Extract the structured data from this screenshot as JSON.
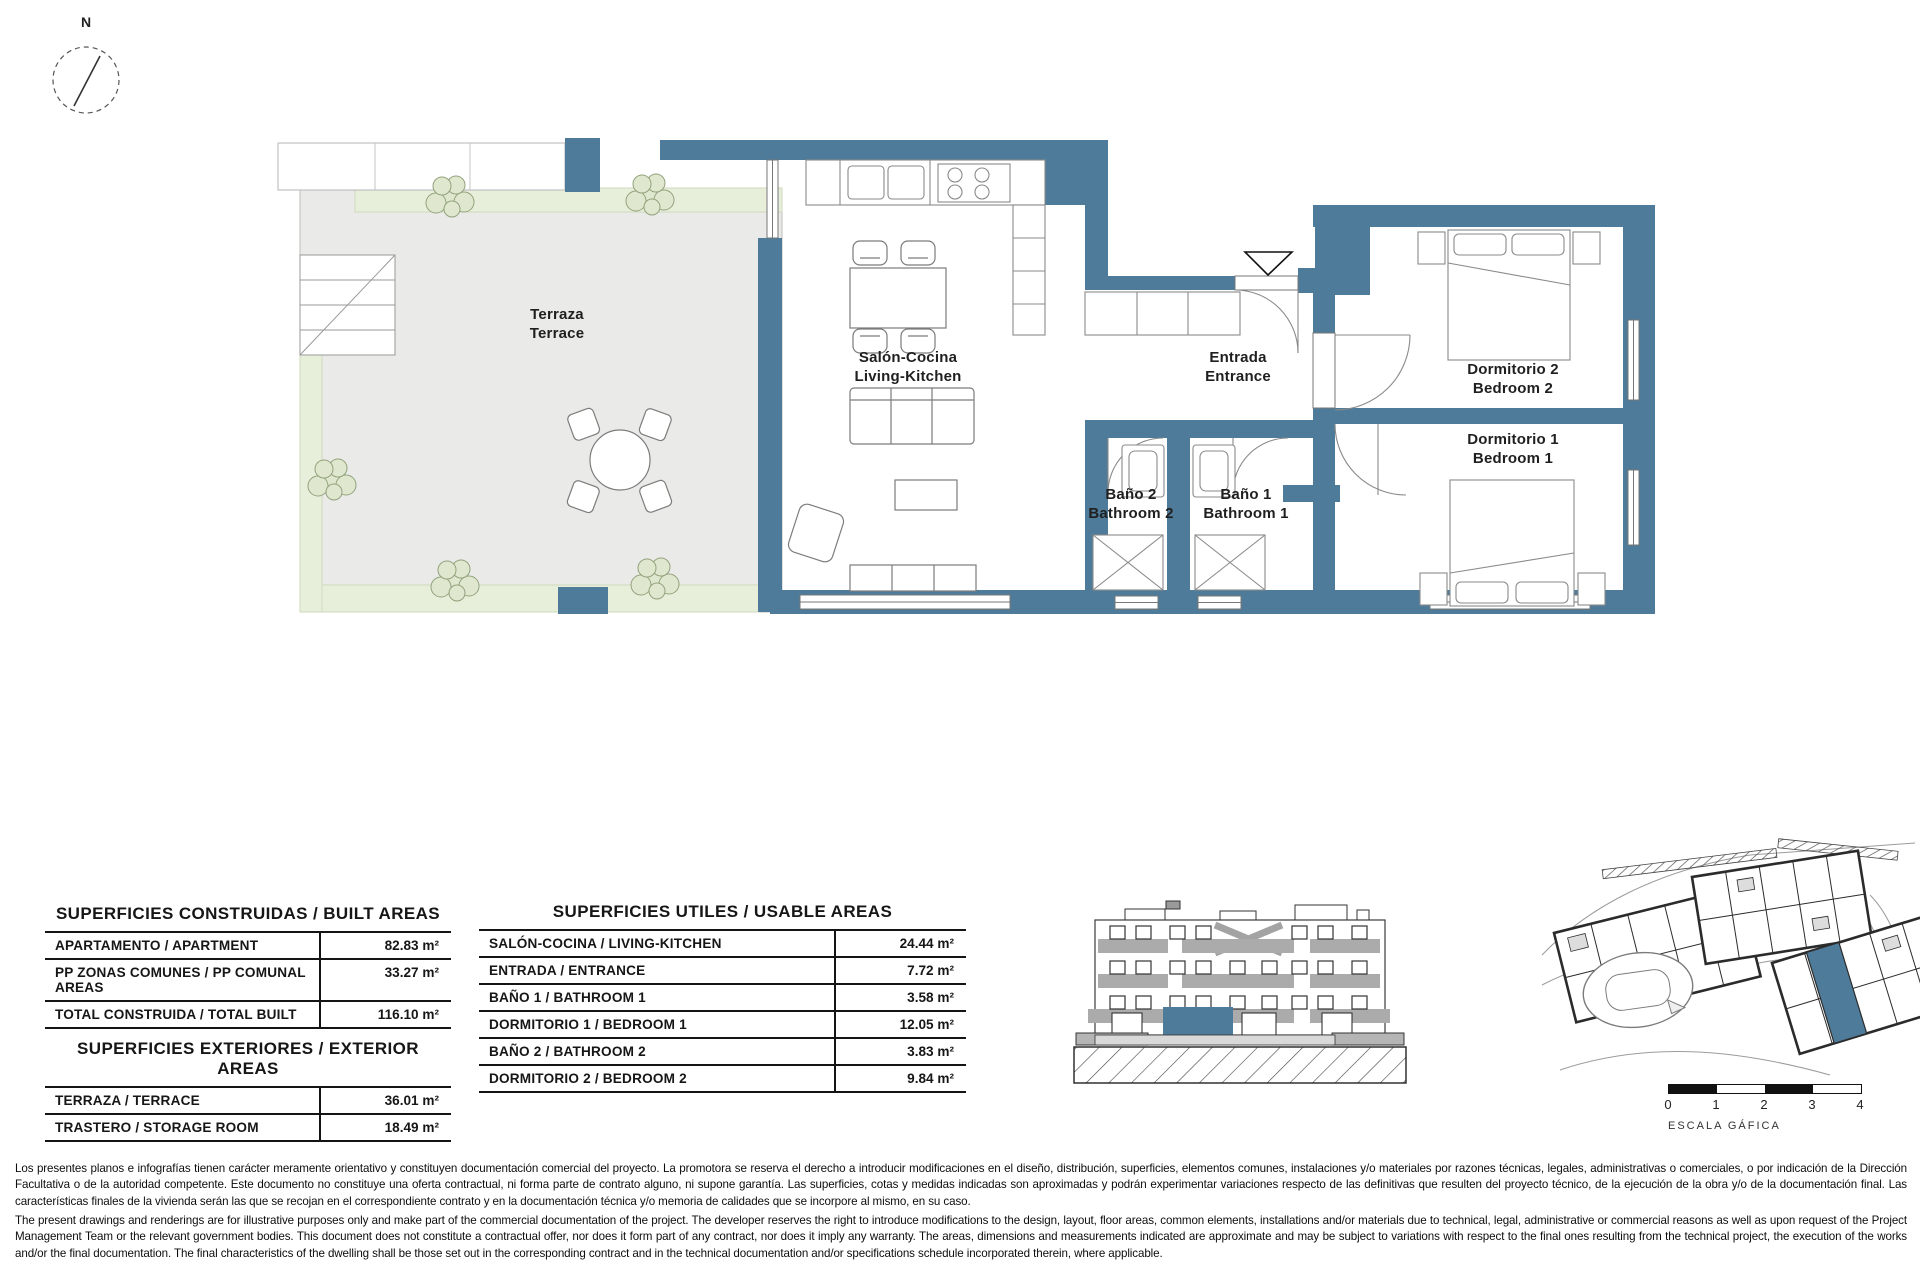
{
  "north": {
    "label": "N"
  },
  "plan": {
    "rooms": {
      "terraza": {
        "es": "Terraza",
        "en": "Terrace"
      },
      "salon": {
        "es": "Salón-Cocina",
        "en": "Living-Kitchen"
      },
      "entrada": {
        "es": "Entrada",
        "en": "Entrance"
      },
      "bano2": {
        "es": "Baño 2",
        "en": "Bathroom 2"
      },
      "bano1": {
        "es": "Baño 1",
        "en": "Bathroom 1"
      },
      "dorm2": {
        "es": "Dormitorio 2",
        "en": "Bedroom 2"
      },
      "dorm1": {
        "es": "Dormitorio 1",
        "en": "Bedroom 1"
      }
    }
  },
  "tables": {
    "built": {
      "title": "SUPERFICIES CONSTRUIDAS / BUILT AREAS",
      "rows": [
        {
          "label": "APARTAMENTO / APARTMENT",
          "value": "82.83 m²"
        },
        {
          "label": "PP ZONAS COMUNES / PP COMUNAL AREAS",
          "value": "33.27 m²"
        },
        {
          "label": "TOTAL CONSTRUIDA / TOTAL BUILT",
          "value": "116.10 m²"
        }
      ]
    },
    "exterior": {
      "title": "SUPERFICIES EXTERIORES / EXTERIOR AREAS",
      "rows": [
        {
          "label": "TERRAZA / TERRACE",
          "value": "36.01 m²"
        },
        {
          "label": "TRASTERO / STORAGE ROOM",
          "value": "18.49 m²"
        }
      ]
    },
    "usable": {
      "title": "SUPERFICIES UTILES / USABLE AREAS",
      "rows": [
        {
          "label": "SALÓN-COCINA / LIVING-KITCHEN",
          "value": "24.44 m²"
        },
        {
          "label": "ENTRADA / ENTRANCE",
          "value": "7.72 m²"
        },
        {
          "label": "BAÑO 1 / BATHROOM 1",
          "value": "3.58 m²"
        },
        {
          "label": "DORMITORIO 1 / BEDROOM 1",
          "value": "12.05 m²"
        },
        {
          "label": "BAÑO 2 / BATHROOM 2",
          "value": "3.83 m²"
        },
        {
          "label": "DORMITORIO 2 / BEDROOM 2",
          "value": "9.84 m²"
        }
      ]
    }
  },
  "scale_bar": {
    "ticks": [
      "0",
      "1",
      "2",
      "3",
      "4"
    ],
    "caption": "ESCALA GÁFICA"
  },
  "disclaimer": {
    "es": "Los presentes planos e infografías tienen carácter meramente orientativo y constituyen documentación comercial del proyecto. La promotora se reserva el derecho a introducir modificaciones en el diseño, distribución, superficies, elementos comunes, instalaciones y/o materiales por razones técnicas, legales, administrativas o comerciales, o por indicación de la Dirección Facultativa o de la autoridad competente. Este documento no constituye una oferta contractual, ni forma parte de contrato alguno, ni supone garantía. Las superficies, cotas y medidas indicadas son aproximadas y podrán experimentar variaciones respecto de las definitivas que resulten del proyecto técnico, de la ejecución de la obra y/o de la documentación final. Las características finales de la vivienda serán las que se recojan en el correspondiente contrato y en la documentación técnica y/o memoria de calidades que se incorpore al mismo, en su caso.",
    "en": "The present drawings and renderings are for illustrative purposes only and make part of the commercial documentation of the project. The developer reserves the right to introduce modifications to the design, layout, floor areas, common elements, installations and/or materials due to technical, legal, administrative or commercial reasons as well as upon request of the Project Management Team or the relevant government bodies. This document does not constitute a contractual offer, nor does it form part of any contract, nor does it imply any warranty. The areas, dimensions and measurements indicated are approximate and may be subject to variations with respect to the final ones resulting from the technical project, the execution of the works and/or the final documentation. The final characteristics of the dwelling shall be those set out in the corresponding contract and in the technical documentation and/or specifications schedule incorporated therein, where applicable.",
    "colors": {
      "wall": "#4e7b99",
      "terrace": "#eaeae8",
      "planting": "#e7eeda",
      "highlight": "#4e7b99"
    }
  }
}
